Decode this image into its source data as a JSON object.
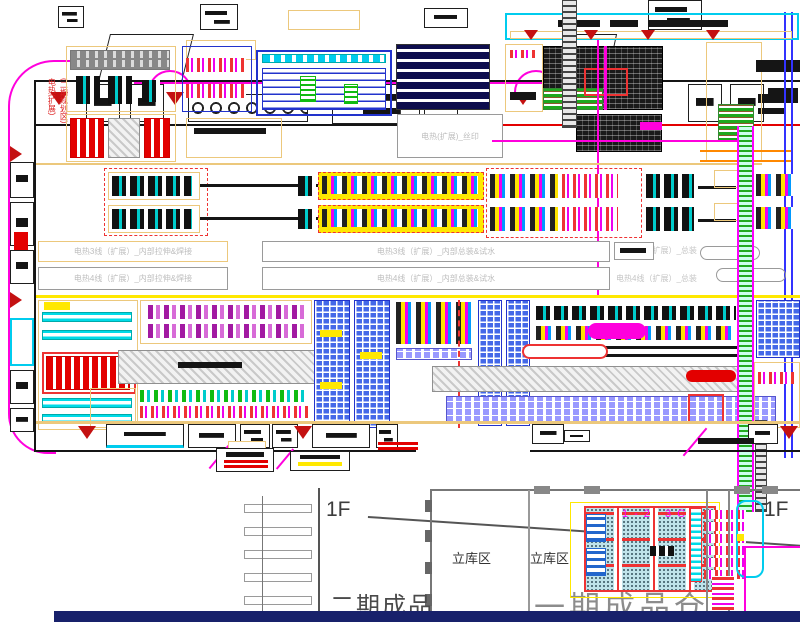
{
  "drawing": {
    "type": "factory-floor-plan-cad",
    "labels": {
      "silk_print_zone": "电热(扩展)_丝印",
      "line3_stretch_weld": "电热3线（扩展）_内部拉伸&焊接",
      "line3_assembly_water_test": "电热3线（扩展）_内部总装&试水",
      "line3_final_assembly": "电热3线（扩展）_总装",
      "line4_stretch_weld": "电热4线（扩展）_内部拉伸&焊接",
      "line4_assembly_water_test": "电热4线（扩展）_内部总装&试水",
      "line4_final_assembly": "电热4线（扩展）_总装",
      "red_vertical_note_line1": "电热(扩展)",
      "red_vertical_note_line2": "(二期规划区)",
      "floor_label_left": "1F",
      "floor_label_right": "1F",
      "stereo_warehouse_left": "立库区",
      "stereo_warehouse_right": "立库区",
      "phase2_finished_goods": "二期成品",
      "phase1_finished_goods_warehouse": "一期成品仓",
      "grid_area_note": "1-2 3C"
    },
    "colors": {
      "wall_tan": "#ecc87c",
      "road_magenta": "#ff00dd",
      "accent_cyan": "#00dbe8",
      "accent_red": "#e30000",
      "accent_yellow": "#ffe800",
      "rack_navy": "#0d0d4d",
      "rack_blue": "#4468e8",
      "machine_purple": "#a219a2",
      "conveyor_green": "#22aa22",
      "footer_navy": "#18216b",
      "label_gray": "#bdbdbd",
      "title_gray": "#8c8c8c"
    }
  }
}
